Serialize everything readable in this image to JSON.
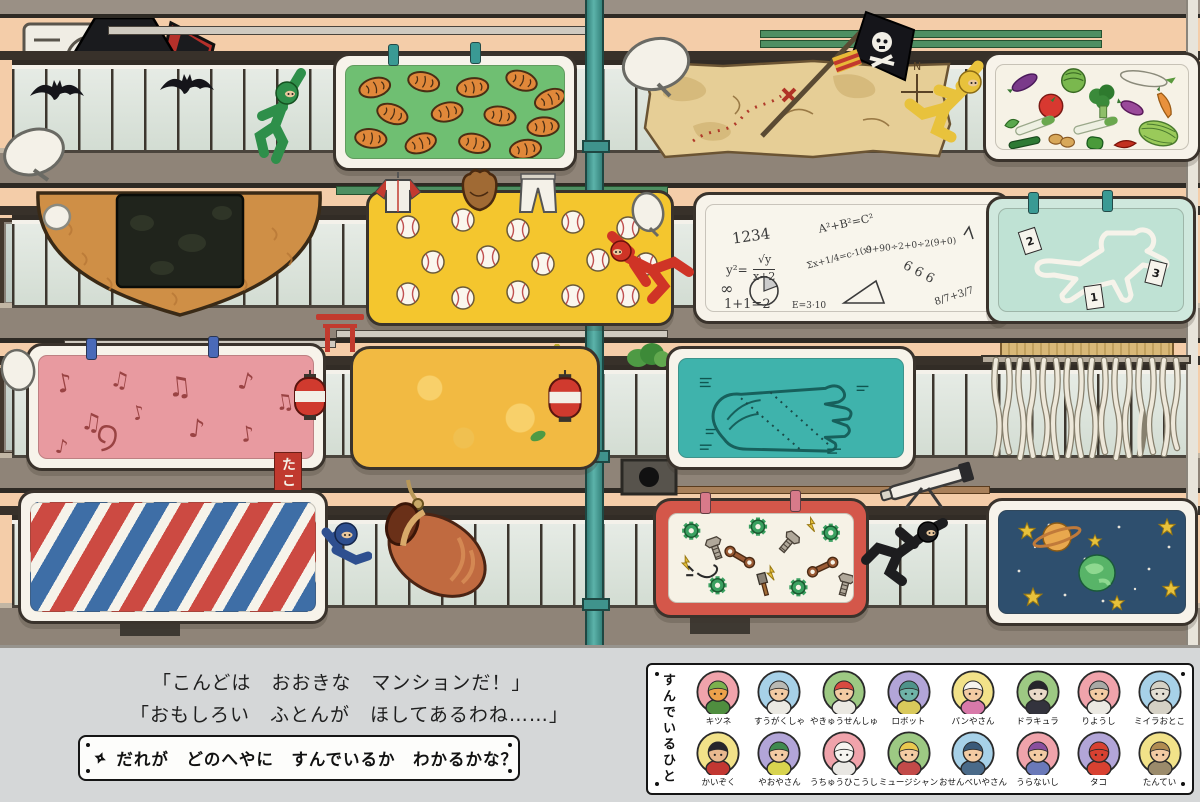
{
  "page": {
    "background": "#d5d7d8"
  },
  "captions": {
    "line1": "「こんどは　おおきな　マンションだ！」",
    "line2": "「おもしろい　ふとんが　ほしてあるわね……」",
    "question": "だれが　どのへやに　すんでいるか　わかるかな？"
  },
  "legend": {
    "title_vertical": "すんでいるひと",
    "rows": [
      [
        {
          "id": "fox",
          "name": "キツネ",
          "bg": "#f0a3ab",
          "skin": "#eda14b",
          "hat": "#7cb14e",
          "shirt": "#4f8e3f"
        },
        {
          "id": "mathematician",
          "name": "すうがくしゃ",
          "bg": "#a7d1e8",
          "skin": "#f3cba3",
          "hat": "#b9b9b4",
          "shirt": "#ebe9e2"
        },
        {
          "id": "baseball-player",
          "name": "やきゅうせんしゅ",
          "bg": "#9dc983",
          "skin": "#f3cba3",
          "hat": "#d84a40",
          "shirt": "#ebe9e2"
        },
        {
          "id": "robot",
          "name": "ロボット",
          "bg": "#b2a5d8",
          "skin": "#6fb3a8",
          "hat": "#4e938a",
          "shirt": "#d9c95b"
        },
        {
          "id": "baker",
          "name": "パンやさん",
          "bg": "#f2e289",
          "skin": "#f3cba3",
          "hat": "#f6f4ee",
          "shirt": "#d879a9"
        },
        {
          "id": "dracula",
          "name": "ドラキュラ",
          "bg": "#9dc983",
          "skin": "#e9dac9",
          "hat": "#26262c",
          "shirt": "#33333d"
        },
        {
          "id": "barber",
          "name": "りようし",
          "bg": "#f0a3ab",
          "skin": "#f3cba3",
          "hat": "#a9a9a5",
          "shirt": "#ebe9e2"
        },
        {
          "id": "mummy",
          "name": "ミイラおとこ",
          "bg": "#a7d1e8",
          "skin": "#e2ded2",
          "hat": "#d5d1c5",
          "shirt": "#d5d1c5"
        }
      ],
      [
        {
          "id": "pirate",
          "name": "かいぞく",
          "bg": "#f2e289",
          "skin": "#e9b98f",
          "hat": "#26262c",
          "shirt": "#c23732"
        },
        {
          "id": "greengrocer",
          "name": "やおやさん",
          "bg": "#b2a5d8",
          "skin": "#f3cba3",
          "hat": "#3f8a4f",
          "shirt": "#d8d44f"
        },
        {
          "id": "astronaut",
          "name": "うちゅうひこうし",
          "bg": "#f0a3ab",
          "skin": "#f6f4f0",
          "hat": "#f6f4f0",
          "shirt": "#e9e7e3"
        },
        {
          "id": "musician",
          "name": "ミュージシャン",
          "bg": "#9dc983",
          "skin": "#f3cba3",
          "hat": "#e9c94f",
          "shirt": "#c24a49"
        },
        {
          "id": "rice-cracker-seller",
          "name": "おせんべいやさん",
          "bg": "#a7d1e8",
          "skin": "#f3cba3",
          "hat": "#3a5a79",
          "shirt": "#4a6a89"
        },
        {
          "id": "fortune-teller",
          "name": "うらないし",
          "bg": "#f0a3ab",
          "skin": "#f3cba3",
          "hat": "#8a4f9f",
          "shirt": "#6a79b9"
        },
        {
          "id": "octopus",
          "name": "タコ",
          "bg": "#b2a5d8",
          "skin": "#d84131",
          "hat": "#d84131",
          "shirt": "#d84131"
        },
        {
          "id": "detective",
          "name": "たんてい",
          "bg": "#f2e289",
          "skin": "#f3cba3",
          "hat": "#b18b51",
          "shirt": "#9b8b6b"
        }
      ]
    ]
  },
  "scene": {
    "banner_text": "たこ",
    "compass_letter": "N",
    "evidence_markers": [
      "1",
      "2",
      "3"
    ],
    "math_formulas": [
      "1234",
      "A²+B²=C²",
      "y²=",
      "√y",
      "x+2",
      "1+1=2",
      "∞",
      "9+90÷2+0÷2(9+0)",
      "6 6 6",
      "8/7+3/7",
      "Σx+1/4=c-1(x)",
      "E=3·10"
    ],
    "palette": {
      "wall": "#f4cda9",
      "slab": "#8f8478",
      "railing_panel": "#e2e8e1",
      "drainpipe": "#48a09a",
      "futon_bread_green": "#6fbf72",
      "futon_baseball_yellow": "#f4c62e",
      "futon_music_pink": "#e89aa0",
      "futon_barber_red": "#cc4a42",
      "futon_barber_blue": "#3e6ea6",
      "futon_palm_teal": "#3fb3ac",
      "futon_space_navy": "#2e4f6e",
      "futon_tools_red": "#d4574a",
      "futon_detective_mint": "#bfe2d4",
      "futon_map_parchment": "#e6ce96",
      "futon_tamago_yellow": "#f2ba42",
      "senbei_brown": "#cf8f46"
    }
  }
}
